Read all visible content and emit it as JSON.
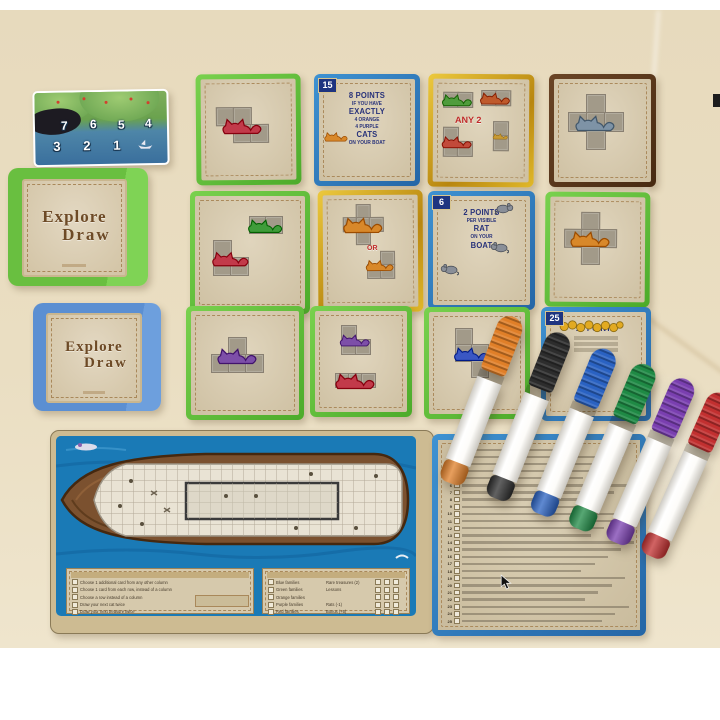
{
  "scene": {
    "background_hex": "#eadec2",
    "surface_hex": "#ffffff",
    "description": "Isle of Cats Explore and Draw board game components photo"
  },
  "day_card": {
    "top_numbers": [
      "7",
      "6",
      "5",
      "4"
    ],
    "bottom_numbers": [
      "3",
      "2",
      "1"
    ]
  },
  "deck_boxes": [
    {
      "name": "green-box",
      "color_hex": "#69bf40",
      "title1": "Explore",
      "title2": "Draw"
    },
    {
      "name": "blue-box",
      "color_hex": "#5b8fd2",
      "title1": "Explore",
      "title2": "Draw"
    }
  ],
  "cards": [
    {
      "name": "card-red-z",
      "x": 196,
      "y": 64,
      "w": 95,
      "h": 101,
      "rot": -0.5,
      "style": "b-green",
      "shapes": [
        {
          "cells": [
            [
              0,
              0
            ],
            [
              1,
              0
            ],
            [
              1,
              1
            ],
            [
              2,
              1
            ]
          ],
          "cs": 17,
          "ox": 15,
          "oy": 28,
          "color": "#c23a4a"
        }
      ]
    },
    {
      "name": "card-15",
      "x": 314,
      "y": 64,
      "w": 96,
      "h": 102,
      "rot": 0,
      "style": "b-blue",
      "number": "15",
      "lines": [
        {
          "t": "8 POINTS",
          "big": 1
        },
        {
          "t": "IF YOU HAVE"
        },
        {
          "t": "EXACTLY",
          "big": 1
        },
        {
          "t": "4 ORANGE"
        },
        {
          "t": "4 PURPLE"
        },
        {
          "t": "CATS",
          "big": 1
        },
        {
          "t": "ON YOUR BOAT"
        }
      ],
      "icons": [
        {
          "type": "cat",
          "x": 4,
          "y": 48,
          "w": 26,
          "h": 17,
          "color": "#d8882a"
        }
      ]
    },
    {
      "name": "card-any2",
      "x": 428,
      "y": 64,
      "w": 96,
      "h": 103,
      "rot": 0.4,
      "style": "b-gold",
      "center_text": "ANY 2",
      "ct_size": 9,
      "ctx": 22,
      "cty": 36,
      "shapes": [
        {
          "cells": [
            [
              0,
              0
            ],
            [
              1,
              0
            ]
          ],
          "cs": 14,
          "ox": 10,
          "oy": 13,
          "color": "#4f9c3c"
        },
        {
          "cells": [
            [
              0,
              0
            ],
            [
              1,
              0
            ]
          ],
          "cs": 14,
          "ox": 48,
          "oy": 11,
          "color": "#bf5a2c"
        },
        {
          "cells": [
            [
              0,
              0
            ],
            [
              0,
              1
            ],
            [
              1,
              1
            ]
          ],
          "cs": 14,
          "ox": 10,
          "oy": 48,
          "color": "#c24a3a"
        },
        {
          "cells": [
            [
              0,
              0
            ],
            [
              0,
              1
            ]
          ],
          "cs": 14,
          "ox": 60,
          "oy": 42,
          "color": "#c89a34"
        }
      ]
    },
    {
      "name": "card-plus-grey",
      "x": 549,
      "y": 64,
      "w": 97,
      "h": 103,
      "rot": 0,
      "style": "b-brown",
      "shapes": [
        {
          "cells": [
            [
              1,
              0
            ],
            [
              0,
              1
            ],
            [
              1,
              1
            ],
            [
              2,
              1
            ],
            [
              1,
              2
            ]
          ],
          "cs": 18,
          "ox": 14,
          "oy": 15,
          "color": "#7e93a6"
        }
      ]
    },
    {
      "name": "card-green-domino-red-l",
      "x": 190,
      "y": 181,
      "w": 110,
      "h": 113,
      "rot": 0,
      "style": "b-green",
      "shapes": [
        {
          "cells": [
            [
              0,
              0
            ],
            [
              1,
              0
            ]
          ],
          "cs": 16,
          "ox": 54,
          "oy": 20,
          "color": "#3f9c3a"
        },
        {
          "cells": [
            [
              0,
              0
            ],
            [
              0,
              1
            ],
            [
              1,
              1
            ]
          ],
          "cs": 17,
          "ox": 18,
          "oy": 44,
          "color": "#c23a4a"
        }
      ]
    },
    {
      "name": "card-or",
      "x": 318,
      "y": 180,
      "w": 95,
      "h": 112,
      "rot": -0.4,
      "style": "b-gold",
      "center_text": "OR",
      "ct_size": 7,
      "ctx": 44,
      "cty": 50,
      "shapes": [
        {
          "cells": [
            [
              1,
              0
            ],
            [
              0,
              1
            ],
            [
              1,
              1
            ],
            [
              2,
              1
            ],
            [
              1,
              2
            ]
          ],
          "cs": 13,
          "ox": 20,
          "oy": 9,
          "color": "#d8882a"
        },
        {
          "cells": [
            [
              1,
              0
            ],
            [
              0,
              1
            ],
            [
              1,
              1
            ]
          ],
          "cs": 13,
          "ox": 44,
          "oy": 56,
          "color": "#d8882a"
        }
      ]
    },
    {
      "name": "card-6-rats",
      "x": 428,
      "y": 181,
      "w": 97,
      "h": 109,
      "rot": 0,
      "style": "b-blue",
      "number": "6",
      "lines": [
        {
          "t": "2 POINTS",
          "big": 1
        },
        {
          "t": "PER VISIBLE"
        },
        {
          "t": "RAT",
          "big": 1
        },
        {
          "t": "ON YOUR"
        },
        {
          "t": "BOAT",
          "big": 1
        }
      ],
      "icons": [
        {
          "type": "rat",
          "x": 62,
          "y": 5,
          "w": 20,
          "h": 14
        },
        {
          "type": "rat",
          "x": 56,
          "y": 44,
          "w": 20,
          "h": 14,
          "flip": 1
        },
        {
          "type": "rat",
          "x": 6,
          "y": 66,
          "w": 20,
          "h": 14,
          "flip": 1
        }
      ]
    },
    {
      "name": "card-plus-orange",
      "x": 545,
      "y": 182,
      "w": 95,
      "h": 105,
      "rot": 0.4,
      "style": "b-green",
      "shapes": [
        {
          "cells": [
            [
              1,
              0
            ],
            [
              0,
              1
            ],
            [
              1,
              1
            ],
            [
              2,
              1
            ],
            [
              1,
              2
            ]
          ],
          "cs": 17,
          "ox": 14,
          "oy": 15,
          "color": "#d8882a"
        }
      ]
    },
    {
      "name": "card-purple-t",
      "x": 186,
      "y": 296,
      "w": 108,
      "h": 104,
      "rot": 0,
      "style": "b-green",
      "shapes": [
        {
          "cells": [
            [
              1,
              0
            ],
            [
              0,
              1
            ],
            [
              1,
              1
            ],
            [
              2,
              1
            ]
          ],
          "cs": 17,
          "ox": 20,
          "oy": 26,
          "color": "#7d4fa8"
        }
      ]
    },
    {
      "name": "card-purple-red",
      "x": 310,
      "y": 296,
      "w": 92,
      "h": 101,
      "rot": 0,
      "style": "b-green",
      "shapes": [
        {
          "cells": [
            [
              0,
              0
            ],
            [
              0,
              1
            ],
            [
              1,
              1
            ]
          ],
          "cs": 14,
          "ox": 26,
          "oy": 14,
          "color": "#7d4fa8"
        },
        {
          "cells": [
            [
              0,
              0
            ],
            [
              1,
              0
            ],
            [
              2,
              0
            ]
          ],
          "cs": 13,
          "ox": 20,
          "oy": 62,
          "color": "#c23a4a"
        }
      ]
    },
    {
      "name": "card-blue-s",
      "x": 424,
      "y": 297,
      "w": 96,
      "h": 102,
      "rot": 0,
      "style": "b-green",
      "shapes": [
        {
          "cells": [
            [
              0,
              0
            ],
            [
              0,
              1
            ],
            [
              1,
              1
            ],
            [
              1,
              2
            ]
          ],
          "cs": 16,
          "ox": 26,
          "oy": 16,
          "color": "#3a57c4"
        }
      ]
    },
    {
      "name": "card-25",
      "x": 541,
      "y": 297,
      "w": 100,
      "h": 104,
      "rot": 0,
      "style": "b-blue",
      "number": "25",
      "lines": [
        {
          "t": "10 POINTS",
          "big": 1
        },
        {
          "bar": 1
        },
        {
          "bar": 1
        },
        {
          "bar": 1
        }
      ],
      "icons": [
        {
          "type": "coins",
          "x": 12,
          "y": 7,
          "w": 66,
          "h": 15
        }
      ]
    }
  ],
  "markers": [
    {
      "name": "orange",
      "hex": "#e07f28"
    },
    {
      "name": "black",
      "hex": "#2d2d2d"
    },
    {
      "name": "blue",
      "hex": "#2a62c2"
    },
    {
      "name": "green",
      "hex": "#1f8a45"
    },
    {
      "name": "purple",
      "hex": "#7a3fb0"
    },
    {
      "name": "red",
      "hex": "#c23030"
    }
  ],
  "ship_board": {
    "actions": [
      "Choose 1 additional card from any other column",
      "Choose 1 card from each row, instead of a column",
      "Choose a row instead of a column",
      "Draw your next cat twice",
      "Draw your next treasure twice"
    ],
    "families": [
      "Blue families",
      "Green families",
      "Orange families",
      "Purple families",
      "Red families"
    ],
    "scoring": [
      "Rare treasures (2)",
      "Lessons",
      "",
      "Rats (-1)",
      "Bonus (+5)"
    ]
  },
  "lesson_sheet": {
    "rows": 25
  }
}
